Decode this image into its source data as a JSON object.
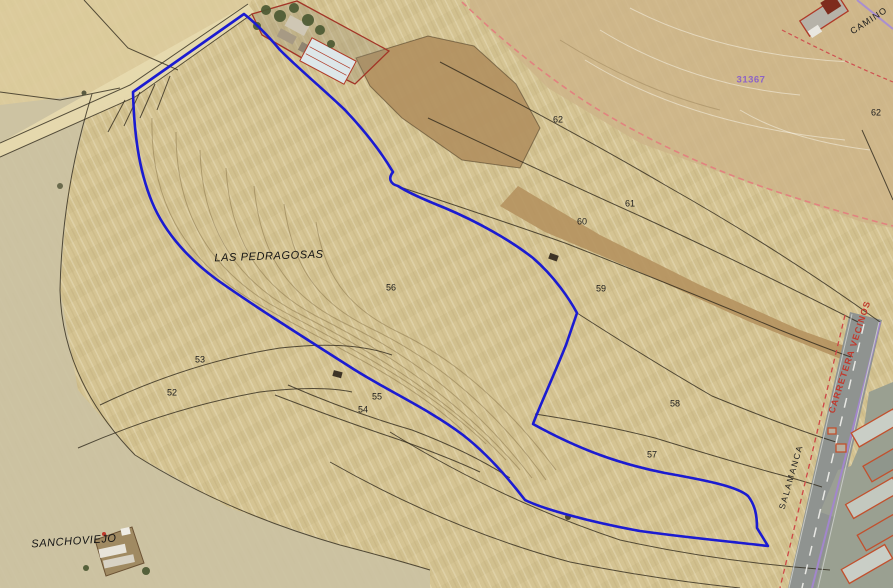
{
  "map": {
    "place_labels_note": "aerial cadastral map with selected parcel outlined in blue",
    "colors": {
      "selected_parcel_outline": "#1b1bd1",
      "cadastral_line": "#2b2519",
      "zone_dashed_boundary": "#e2837f",
      "road_dashed_boundary": "#cf4747",
      "road_side_purple": "#a286cc",
      "building_outline_red": "#c2502d",
      "reference_text_purple": "#8d63c6",
      "road_text_red": "#c03a2e"
    },
    "labels": [
      {
        "id": "place-las-pedragosas",
        "text": "LAS PEDRAGOSAS",
        "x": 269,
        "y": 257,
        "rot": -2,
        "cls": "place"
      },
      {
        "id": "place-sanchoviejo",
        "text": "SANCHOVIEJO",
        "x": 74,
        "y": 542,
        "rot": -4,
        "cls": "place"
      },
      {
        "id": "parcel-52",
        "text": "52",
        "x": 172,
        "y": 393,
        "cls": "parcel"
      },
      {
        "id": "parcel-53",
        "text": "53",
        "x": 200,
        "y": 360,
        "cls": "parcel"
      },
      {
        "id": "parcel-54",
        "text": "54",
        "x": 363,
        "y": 410,
        "cls": "parcel"
      },
      {
        "id": "parcel-55",
        "text": "55",
        "x": 377,
        "y": 397,
        "cls": "parcel"
      },
      {
        "id": "parcel-56",
        "text": "56",
        "x": 391,
        "y": 288,
        "cls": "parcel"
      },
      {
        "id": "parcel-57",
        "text": "57",
        "x": 652,
        "y": 455,
        "cls": "parcel"
      },
      {
        "id": "parcel-58",
        "text": "58",
        "x": 675,
        "y": 404,
        "cls": "parcel"
      },
      {
        "id": "parcel-59",
        "text": "59",
        "x": 601,
        "y": 289,
        "cls": "parcel"
      },
      {
        "id": "parcel-60",
        "text": "60",
        "x": 582,
        "y": 222,
        "cls": "parcel"
      },
      {
        "id": "parcel-61",
        "text": "61",
        "x": 630,
        "y": 204,
        "cls": "parcel"
      },
      {
        "id": "parcel-62",
        "text": "62",
        "x": 558,
        "y": 120,
        "cls": "parcel"
      },
      {
        "id": "parcel-62-east",
        "text": "62",
        "x": 876,
        "y": 113,
        "cls": "parcel"
      },
      {
        "id": "ref-31367",
        "text": "31367",
        "x": 751,
        "y": 80,
        "cls": "ref"
      },
      {
        "id": "road-camino",
        "text": "CAMINO",
        "x": 869,
        "y": 21,
        "rot": -33,
        "cls": "road-black"
      },
      {
        "id": "road-carretera-vecinos",
        "text": "CARRETERA VECINOS",
        "x": 850,
        "y": 357,
        "rot": -72,
        "cls": "road-red"
      },
      {
        "id": "road-salamanca",
        "text": "SALAMANCA",
        "x": 791,
        "y": 477,
        "rot": -74,
        "cls": "road-black-small"
      }
    ]
  }
}
